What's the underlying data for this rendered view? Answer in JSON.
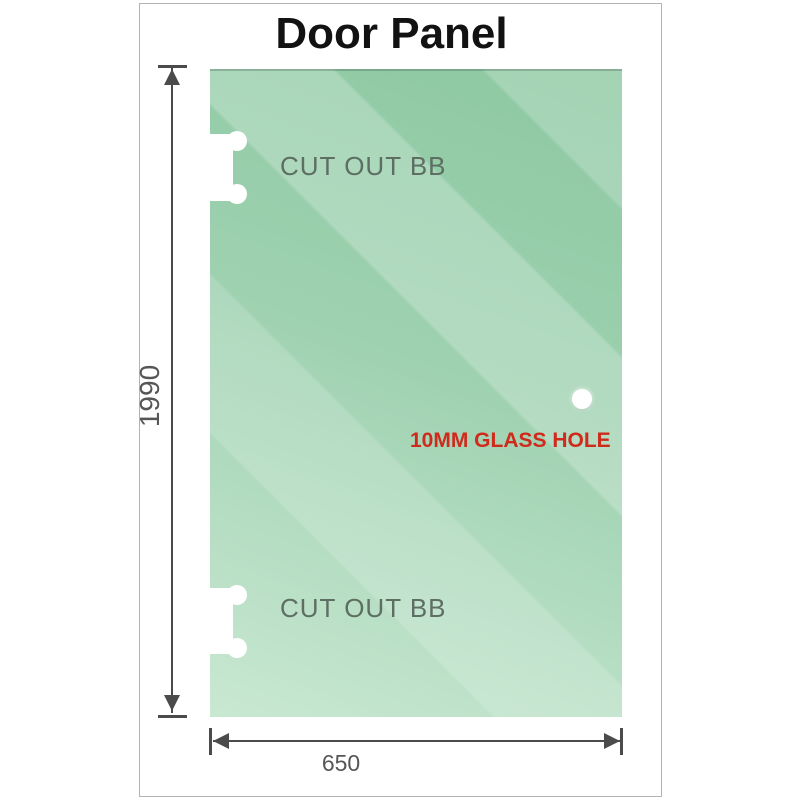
{
  "title": "Door Panel",
  "panel": {
    "cutout_top_label": "CUT OUT BB",
    "cutout_bottom_label": "CUT OUT BB",
    "hole_label": "10MM GLASS HOLE"
  },
  "dimensions": {
    "height_label": "1990",
    "width_label": "650"
  },
  "colors": {
    "title_black": "#121212",
    "border_gray": "#b3b3b3",
    "glass_top": "#8cc8a1",
    "glass_bottom": "#c9e8d2",
    "cutout_label_gray": "#5d6e63",
    "hole_label_red": "#cf2a1b",
    "dimension_gray": "#4b4b4b",
    "dim_text_gray": "#565656"
  }
}
